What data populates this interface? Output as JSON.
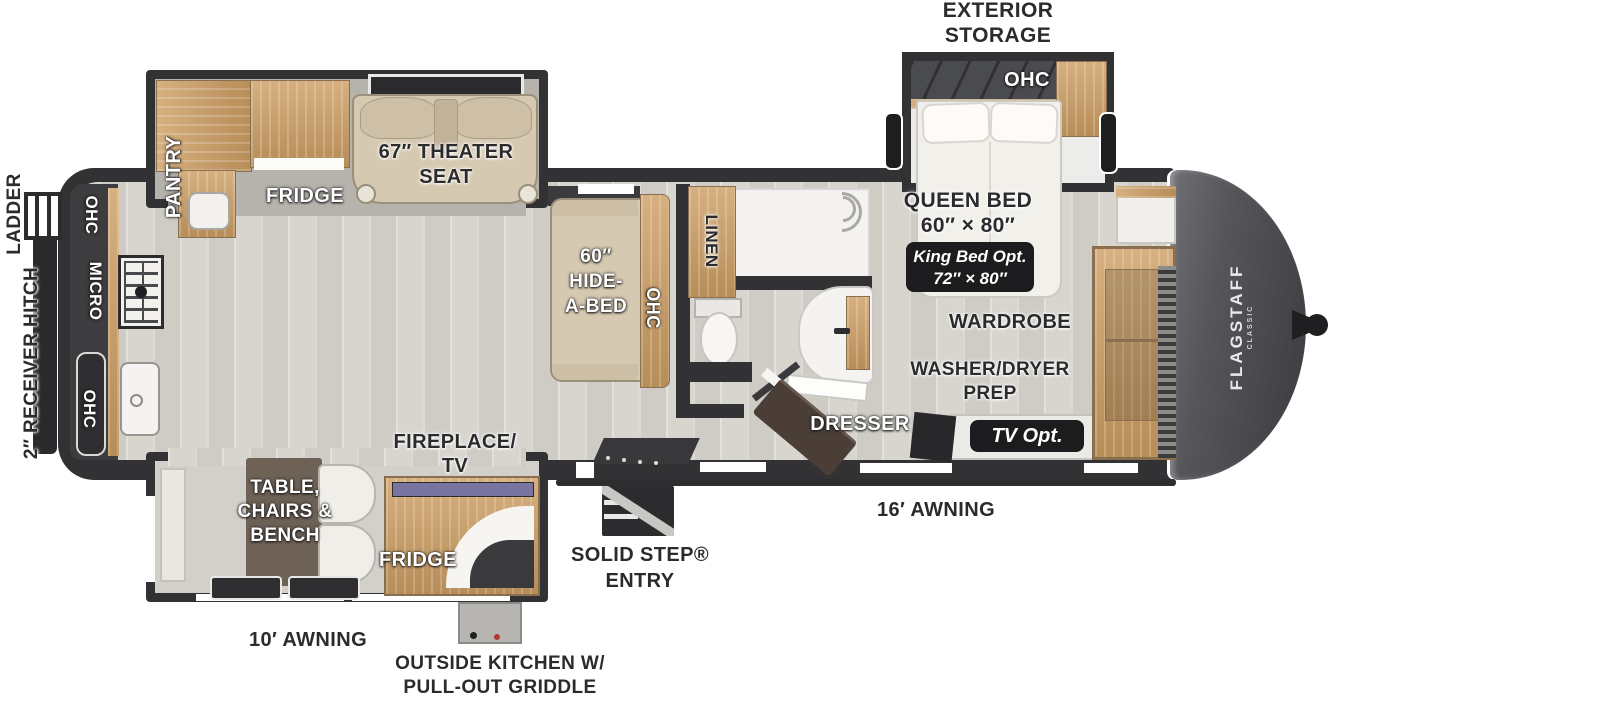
{
  "brand": {
    "name": "FLAGSTAFF",
    "series": "CLASSIC"
  },
  "labels": {
    "exterior_storage_1": "EXTERIOR",
    "exterior_storage_2": "STORAGE",
    "ohc": "OHC",
    "micro": "MICRO",
    "pantry": "PANTRY",
    "fridge": "FRIDGE",
    "linen": "LINEN",
    "theater_1": "67″ THEATER",
    "theater_2": "SEAT",
    "hide_a_bed_1": "60″",
    "hide_a_bed_2": "HIDE-",
    "hide_a_bed_3": "A-BED",
    "queen_bed_1": "QUEEN BED",
    "queen_bed_2": "60″ × 80″",
    "king_opt_1": "King Bed Opt.",
    "king_opt_2": "72″ × 80″",
    "wardrobe": "WARDROBE",
    "washer_dryer_1": "WASHER/DRYER",
    "washer_dryer_2": "PREP",
    "dresser": "DRESSER",
    "tv_opt": "TV Opt.",
    "ladder": "LADDER",
    "receiver_hitch": "2″ RECEIVER HITCH",
    "solid_step_1": "SOLID STEP®",
    "solid_step_2": "ENTRY",
    "awning_16": "16′ AWNING",
    "awning_10": "10′ AWNING",
    "outside_kitchen_1": "OUTSIDE KITCHEN W/",
    "outside_kitchen_2": "PULL-OUT GRIDDLE",
    "fireplace_1": "FIREPLACE/",
    "fireplace_2": "TV",
    "table_1": "TABLE,",
    "table_2": "CHAIRS &",
    "table_3": "BENCH"
  },
  "colors": {
    "wall": "#323234",
    "floor": "#d6d3cd",
    "slide_floor": "#b6b3ad",
    "wood": "#c9a36f",
    "cushion": "#d6c9b1",
    "dresser": "#4a3e37",
    "nose": "#46474b",
    "badge_bg": "#1c1c1e",
    "tv_screen": "#7a74a0",
    "label_dark": "#2b2b2d",
    "label_light": "#ffffff"
  }
}
